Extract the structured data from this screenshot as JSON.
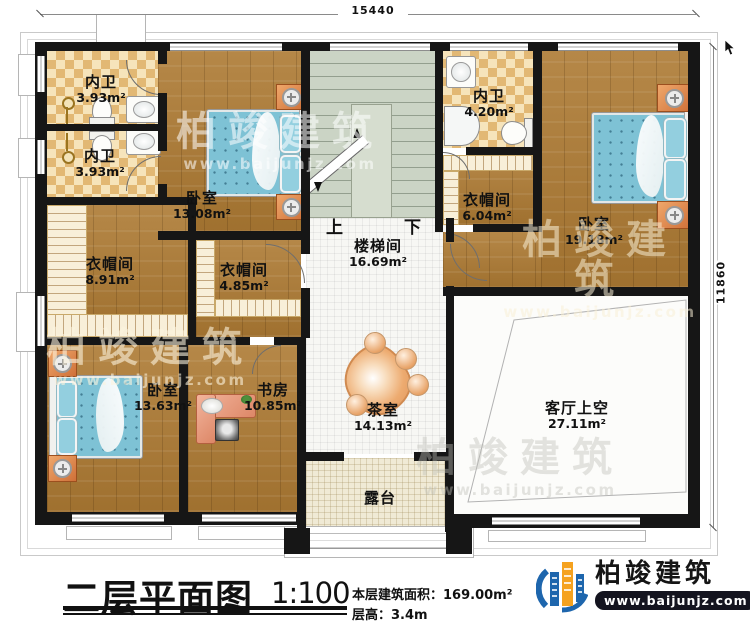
{
  "dimensions": {
    "top_width": "15440",
    "right_height": "11860"
  },
  "stairs": {
    "up": "上",
    "down": "下"
  },
  "rooms": {
    "bath_top_1": {
      "name": "内卫",
      "area": "3.93m²"
    },
    "bath_top_2": {
      "name": "内卫",
      "area": "3.93m²"
    },
    "bedroom_top": {
      "name": "卧室",
      "area": "13.08m²"
    },
    "bath_right": {
      "name": "内卫",
      "area": "4.20m²"
    },
    "cloak_right": {
      "name": "衣帽间",
      "area": "6.04m²"
    },
    "bedroom_right": {
      "name": "卧室",
      "area": "19.18m²"
    },
    "stairwell": {
      "name": "楼梯间",
      "area": "16.69m²"
    },
    "cloak_left": {
      "name": "衣帽间",
      "area": "8.91m²"
    },
    "cloak_mid": {
      "name": "衣帽间",
      "area": "4.85m²"
    },
    "bedroom_left": {
      "name": "卧室",
      "area": "13.63m²"
    },
    "study": {
      "name": "书房",
      "area": "10.85m²"
    },
    "tea_room": {
      "name": "茶室",
      "area": "14.13m²"
    },
    "living_void": {
      "name": "客厅上空",
      "area": "27.11m²"
    },
    "terrace": {
      "name": "露台"
    }
  },
  "title_block": {
    "title": "二层平面图",
    "scale": "1:100",
    "floor_area": "本层建筑面积：169.00m²",
    "floor_height": "层高：3.4m"
  },
  "brand": {
    "name": "柏竣建筑",
    "website": "www.baijunjz.com"
  },
  "watermark": {
    "text": "柏竣建筑",
    "website": "www.baijunjz.com"
  },
  "colors": {
    "wall": "#161616",
    "wood_floor": "#ad7a33",
    "checker_tile": "#e2b874",
    "stair_floor": "#cbd4c5",
    "bed": "#7ec2d5",
    "furniture_accent": "#d97f45",
    "brand_blue": "#1e66ad",
    "brand_orange": "#f5a21f"
  }
}
